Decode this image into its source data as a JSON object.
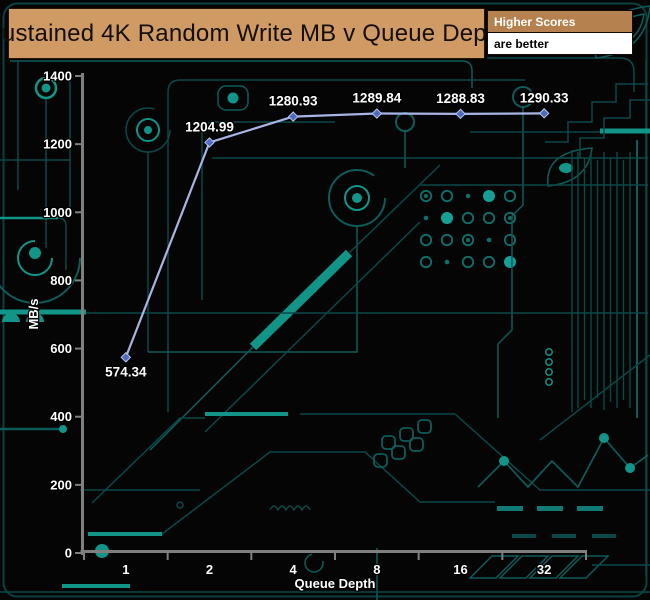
{
  "header": {
    "title": "Sustained 4K Random Write MB v Queue Depth",
    "legend_top": "Higher Scores",
    "legend_bottom": "are better"
  },
  "chart_data": {
    "type": "line",
    "title": "Sustained 4K Random Write MB v Queue Depth",
    "categories": [
      "1",
      "2",
      "4",
      "8",
      "16",
      "32"
    ],
    "series": [
      {
        "name": "Sustained 4K Random Write",
        "values": [
          574.34,
          1204.99,
          1280.93,
          1289.84,
          1288.83,
          1290.33
        ]
      }
    ],
    "point_labels": [
      "574.34",
      "1204.99",
      "1280.93",
      "1289.84",
      "1288.83",
      "1290.33"
    ],
    "xlabel": "Queue Depth",
    "ylabel": "MB/s",
    "ylim": [
      0,
      1400
    ],
    "ytick_step": 200,
    "yticks": [
      "0",
      "200",
      "400",
      "600",
      "800",
      "1000",
      "1200",
      "1400"
    ],
    "grid": false,
    "legend_position": "top-right",
    "notes": "higher scores are better"
  },
  "colors": {
    "background": "#050505",
    "trace_dim": "#0b4848",
    "trace_mid": "#0e5c5a",
    "trace_bright": "#129488",
    "title_bg": "#cf9a63",
    "title_text": "#140e07",
    "legend_bg": "#b5824f",
    "legend_text": "#ffffff",
    "legend2_bg": "#ffffff",
    "legend2_text": "#000000",
    "axis": "#7f7f7f",
    "tick_text": "#ffffff",
    "line": "#a8b4e4",
    "marker": "#4e6bbf",
    "marker_stroke": "#b9c4ea",
    "data_label": "#ffffff"
  }
}
